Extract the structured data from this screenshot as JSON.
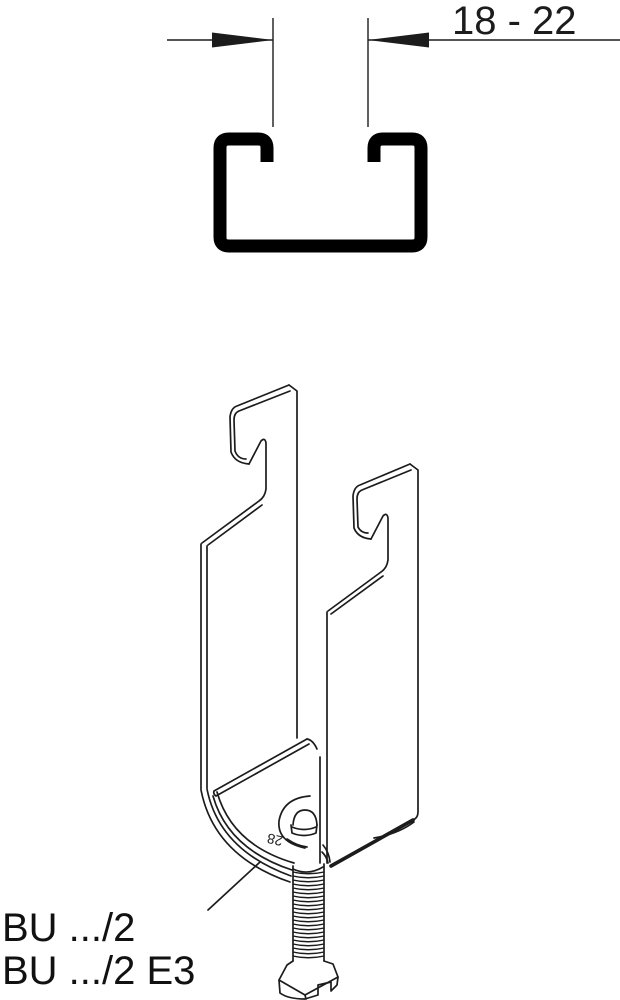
{
  "page": {
    "background": "#ffffff",
    "line_color": "#1c1c1c",
    "description": "Technical line drawing of a BU stirrup cable clamp under a C-profile mounting channel"
  },
  "dimension": {
    "label": "18 - 22"
  },
  "stamp": {
    "label": "28"
  },
  "product_labels": {
    "line1": "BU .../2",
    "line2": "BU .../2 E3"
  }
}
